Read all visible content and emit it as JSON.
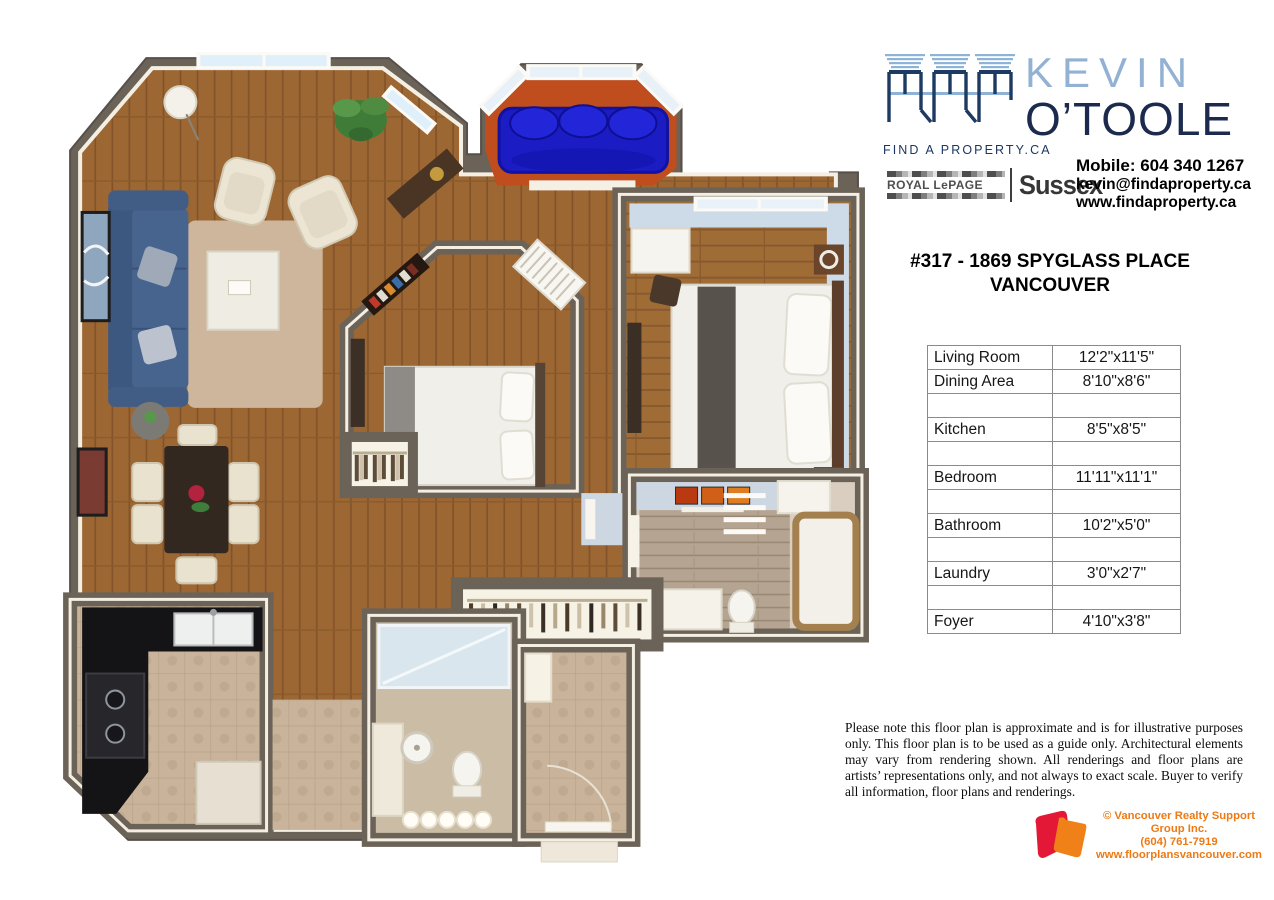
{
  "branding": {
    "fap_logo_label": "FIND A PROPERTY.CA",
    "agent_first_name": "KEVIN",
    "agent_last_name": "O’TOOLE",
    "brokerage_brand": "ROYAL LePAGE",
    "brokerage_office": "Sussex",
    "contact_mobile": "Mobile: 604 340 1267",
    "contact_email": "kevin@findaproperty.ca",
    "contact_website": "www.findaproperty.ca"
  },
  "property": {
    "address_line1": "#317 - 1869 SPYGLASS PLACE",
    "address_line2": "VANCOUVER"
  },
  "room_table": {
    "rows": [
      {
        "room": "Living Room",
        "size": "12'2\"x11'5\""
      },
      {
        "room": "Dining Area",
        "size": "8'10\"x8'6\""
      },
      {
        "room": "",
        "size": ""
      },
      {
        "room": "Kitchen",
        "size": "8'5\"x8'5\""
      },
      {
        "room": "",
        "size": ""
      },
      {
        "room": "Bedroom",
        "size": "11'11\"x11'1\""
      },
      {
        "room": "",
        "size": ""
      },
      {
        "room": "Bathroom",
        "size": "10'2\"x5'0\""
      },
      {
        "room": "",
        "size": ""
      },
      {
        "room": "Laundry",
        "size": "3'0\"x2'7\""
      },
      {
        "room": "",
        "size": ""
      },
      {
        "room": "Foyer",
        "size": "4'10\"x3'8\""
      }
    ]
  },
  "disclaimer_text": "Please note this floor plan is approximate and is for illustrative purposes only.  This floor plan is to be used as a guide only. Architectural elements may vary from rendering shown. All renderings and floor plans are artists’ representations only, and not always to exact scale. Buyer to verify all information, floor plans and renderings.",
  "footer": {
    "company": "© Vancouver Realty Support Group Inc.",
    "phone": "(604) 761-7919",
    "website": "www.floorplansvancouver.com"
  },
  "floor_plan": {
    "rooms_shown": [
      "Living Room",
      "Dining Area",
      "Kitchen",
      "Balcony",
      "Bedroom",
      "Den/Second Bedroom",
      "Bathroom",
      "Second Bathroom",
      "Laundry",
      "Closet",
      "Foyer"
    ],
    "colors": {
      "wall": "#6b6258",
      "wood_floor": "#9c6733",
      "rug": "#cdb69c",
      "sofa_blue": "#47648e",
      "balcony_cushion_blue": "#1b1cc4",
      "balcony_floor_terracotta": "#bf4d1e",
      "bedroom_wall_blue": "#cddbe8",
      "kitchen_counter_black": "#141417",
      "tile_floor": "#c9b49b",
      "brand_navy": "#1b2a4d",
      "brand_light_blue": "#93b2d3",
      "footer_orange": "#ed7a15",
      "footer_red": "#e31837"
    }
  }
}
